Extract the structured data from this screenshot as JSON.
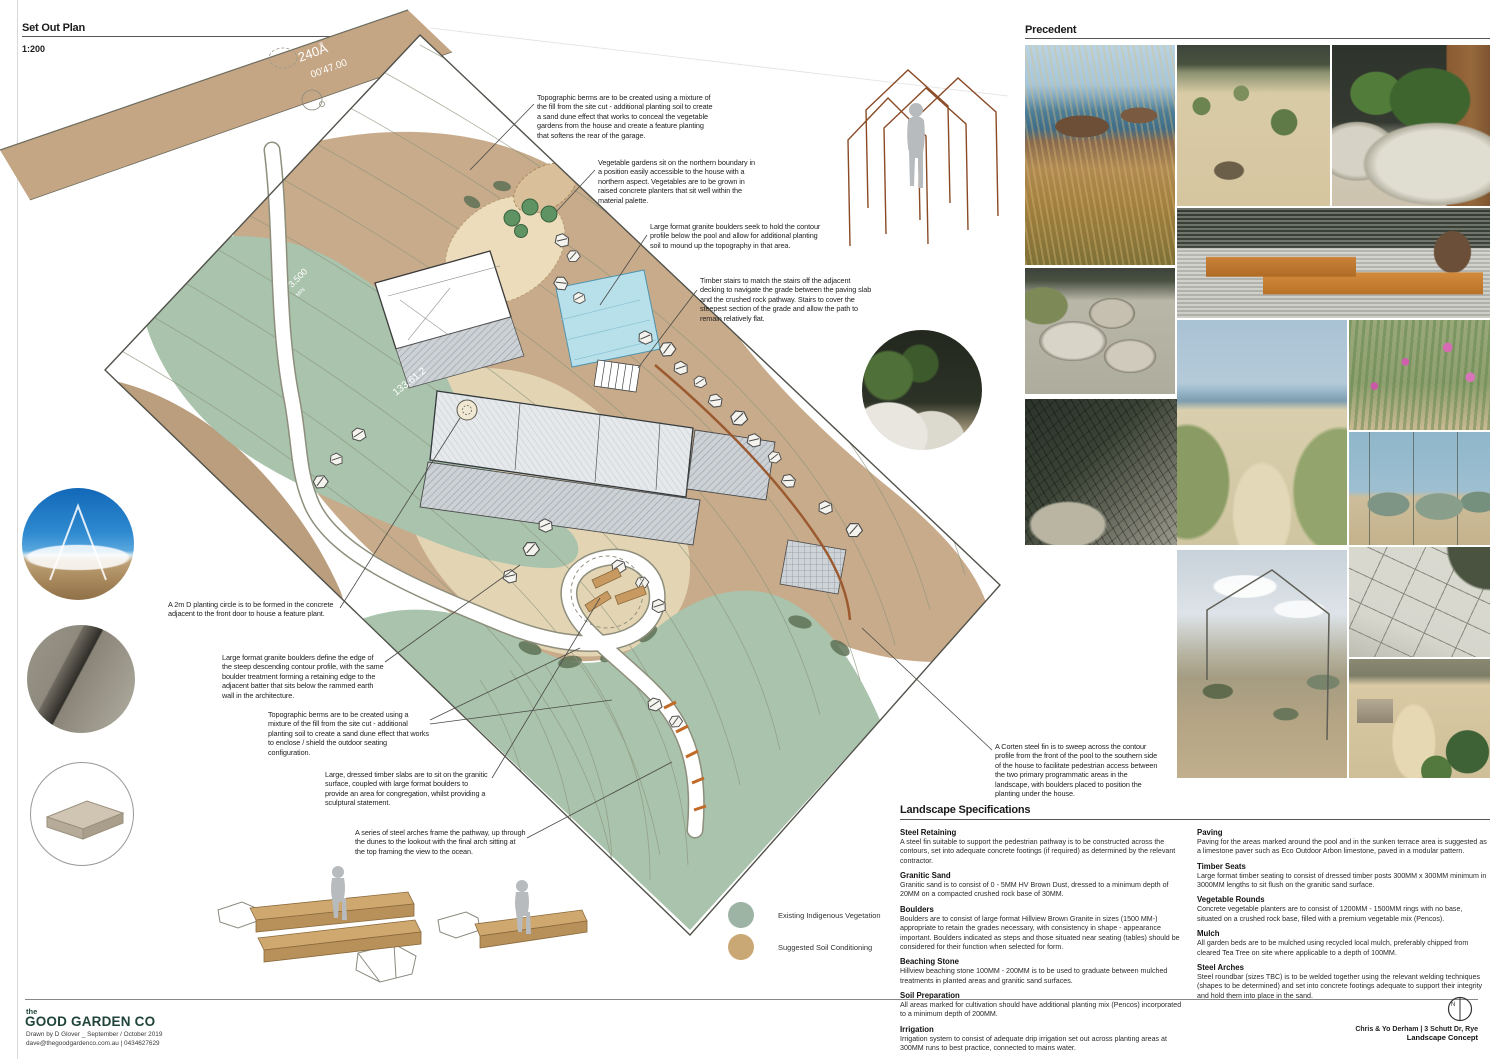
{
  "header": {
    "title": "Set Out Plan",
    "scale": "1:200"
  },
  "precedent": {
    "title": "Precedent",
    "photos": [
      "coastal-dune-beach",
      "native-sand-garden",
      "concrete-vegetable-planters",
      "timber-bench-seating",
      "boulder-outcrop-garden",
      "moonah-tree-canopy",
      "dune-path-to-ocean",
      "pigface-groundcover",
      "agave-flower-spikes",
      "steel-arch-sculpture-desert",
      "limestone-paving",
      "gravel-path-gabions"
    ]
  },
  "plan": {
    "bearing_line1": "240Å",
    "bearing_line2": "00'47.00",
    "dim_boundary": "133.61.2",
    "dim_min1": "3.500",
    "dim_min2": "MIN",
    "annotations": [
      {
        "text": "Topographic berms are to be created using a mixture of the fill from the site cut - additional planting soil to create a sand dune effect that works to conceal the vegetable gardens from the house and create a feature planting that softens the rear of the garage."
      },
      {
        "text": "Vegetable gardens sit on the northern boundary in a position easily accessible to the house with a northern aspect. Vegetables are to be grown in raised concrete planters that sit well within the material palette."
      },
      {
        "text": "Large format granite boulders seek to hold the contour profile below the pool and allow for additional planting soil to mound up the topography in that area."
      },
      {
        "text": "Timber stairs to match the stairs off the adjacent decking to navigate the grade between the paving slab and the crushed rock pathway. Stairs to cover the steepest section of the grade and allow the path to remain relatively flat."
      },
      {
        "text": "A 2m D planting circle is to be formed in the concrete adjacent to the front door to house a feature plant."
      },
      {
        "text": "Large format granite boulders define the edge of the steep descending contour profile, with the same boulder treatment forming a retaining edge to the adjacent batter that sits below the rammed earth wall in the architecture."
      },
      {
        "text": "Topographic berms are to be created using a mixture of the fill from the site cut - additional planting soil to create a sand dune effect that works to enclose / shield the outdoor seating configuration."
      },
      {
        "text": "Large, dressed timber slabs are to sit on the granitic surface, coupled with large format boulders to provide an area for congregation, whilst providing a sculptural statement."
      },
      {
        "text": "A series of steel arches frame the pathway, up through the dunes to the lookout with the final arch sitting at the top framing the view to the ocean."
      },
      {
        "text": "A Corten steel fin is to sweep across the contour profile from the front of the pool to the southern side of the house to facilitate pedestrian access between the two primary programmatic areas in the landscape, with boulders placed to position the planting under the house."
      }
    ],
    "legend": [
      {
        "label": "Existing Indigenous Vegetation",
        "color": "#9db3a4"
      },
      {
        "label": "Suggested Soil Conditioning",
        "color": "#c9a876"
      }
    ]
  },
  "specifications": {
    "title": "Landscape Specifications",
    "left": [
      {
        "title": "Steel Retaining",
        "body": "A steel fin suitable to support the pedestrian pathway is to be constructed across the contours, set into adequate concrete footings (if required) as determined by the relevant contractor."
      },
      {
        "title": "Granitic Sand",
        "body": "Granitic sand is to consist of 0 - 5MM HV Brown Dust, dressed to a minimum depth of 20MM on a compacted crushed rock base of 30MM."
      },
      {
        "title": "Boulders",
        "body": "Boulders are to consist of large format Hillview Brown Granite in sizes (1500 MM-) appropriate to retain the grades necessary, with consistency in shape - appearance important. Boulders indicated as steps and those situated near seating (tables) should be considered for their function when selected for form."
      },
      {
        "title": "Beaching Stone",
        "body": "Hillview beaching stone 100MM - 200MM is to be used to graduate between mulched treatments in planted areas and granitic sand surfaces."
      },
      {
        "title": "Soil Preparation",
        "body": "All areas marked for cultivation should have additional planting mix (Pencos) incorporated to a minimum depth of 200MM."
      },
      {
        "title": "Irrigation",
        "body": "Irrigation system to consist of adequate drip irrigation set out across planting areas at 300MM runs to best practice, connected to mains water."
      }
    ],
    "right": [
      {
        "title": "Paving",
        "body": "Paving for the areas marked around the pool and in the sunken terrace area is suggested as a limestone paver such as Eco Outdoor Arbon limestone, paved in a modular pattern."
      },
      {
        "title": "Timber Seats",
        "body": "Large format timber seating to consist of dressed timber posts 300MM x 300MM minimum in 3000MM lengths to sit flush on the granitic sand surface."
      },
      {
        "title": "Vegetable Rounds",
        "body": "Concrete vegetable planters are to consist of 1200MM - 1500MM rings with no base, situated on a crushed rock base, filled with a premium vegetable mix (Pencos)."
      },
      {
        "title": "Mulch",
        "body": "All garden beds are to be mulched using recycled local mulch, preferably chipped from cleared Tea Tree on site where applicable to a depth of 100MM."
      },
      {
        "title": "Steel Arches",
        "body": "Steel roundbar (sizes TBC) is to be welded together using the relevant welding techniques (shapes to be determined) and set into concrete footings adequate to support their integrity and hold them into place in the sand."
      }
    ]
  },
  "footer": {
    "logo_small": "the",
    "logo_name": "GOOD GARDEN CO",
    "credit_line1": "Drawn by D Glover _ September / October 2019",
    "credit_line2": "dave@thegoodgardenco.com.au | 0434627629",
    "client_line": "Chris & Yo Derham | 3 Schutt Dr, Rye",
    "doc_title": "Landscape Concept",
    "north": "N"
  },
  "colors": {
    "sage_vegetation": "#a9c3ac",
    "sand_tan": "#c8ab8a",
    "pale_sand": "#e3d5b4",
    "corten": "#9c5a30",
    "logo_green": "#20443a"
  }
}
